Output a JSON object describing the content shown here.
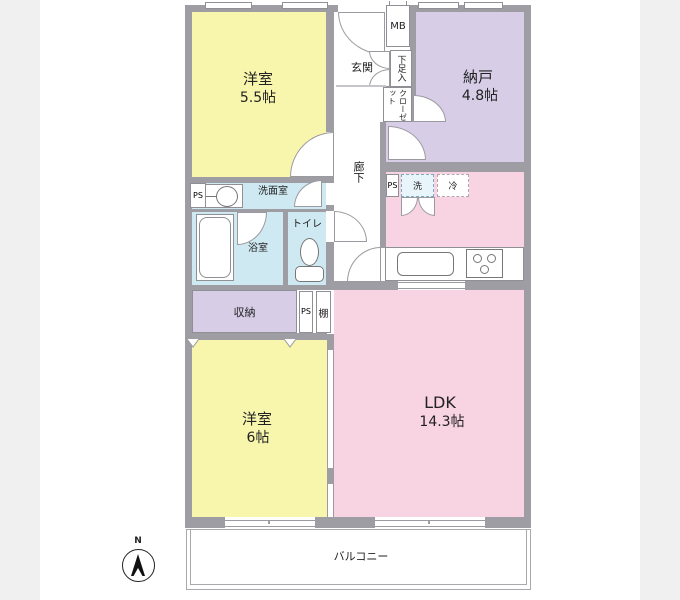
{
  "page": {
    "background": "#f0f0f1",
    "panel": "#ffffff"
  },
  "colors": {
    "wall": "#9d9da3",
    "room_yellow": "#f8f6ad",
    "room_purple": "#d7cde7",
    "room_pink": "#f8d3e2",
    "room_blue": "#cfe9f2",
    "outline": "#8f8f96"
  },
  "floorplan": {
    "rooms": {
      "bedroom1": {
        "name": "洋室",
        "size": "5.5帖"
      },
      "storage_room": {
        "name": "納戸",
        "size": "4.8帖"
      },
      "bedroom2": {
        "name": "洋室",
        "size": "6帖"
      },
      "ldk": {
        "name": "LDK",
        "size": "14.3帖"
      }
    },
    "labels": {
      "entrance": "玄関",
      "meter_box": "MB",
      "shoe_box": "下足入",
      "closet": "クローゼット",
      "hallway": "廊下",
      "pipe_space": "PS",
      "washroom": "洗面室",
      "bathroom": "浴室",
      "toilet": "トイレ",
      "washer": "洗",
      "fridge": "冷",
      "storage": "収納",
      "shelf": "棚",
      "balcony": "バルコニー",
      "north": "N"
    }
  }
}
